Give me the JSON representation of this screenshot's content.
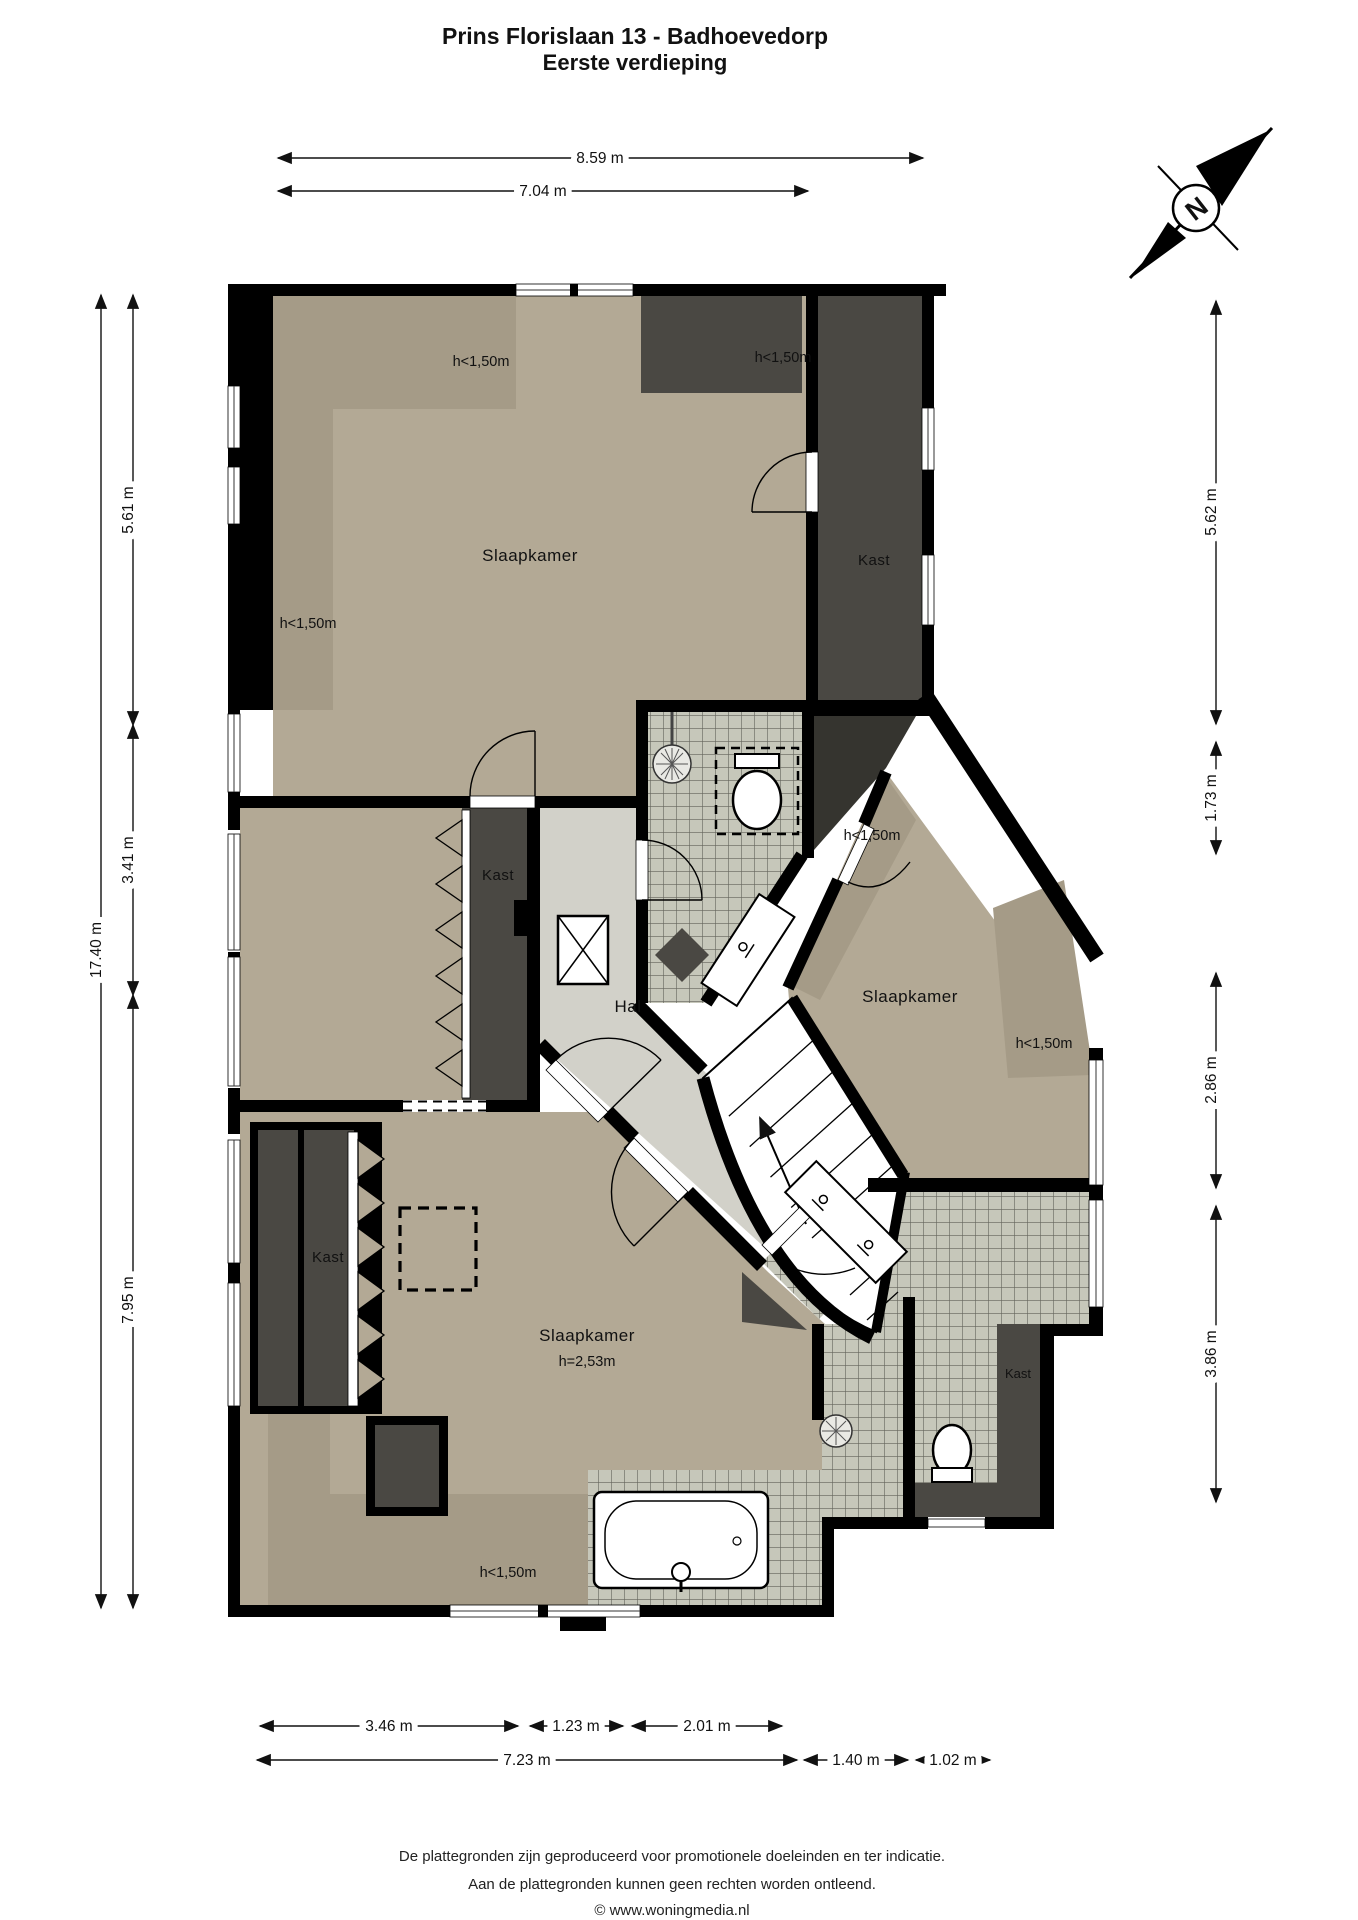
{
  "title": {
    "line1": "Prins Florislaan 13 - Badhoevedorp",
    "line2": "Eerste verdieping"
  },
  "compass": {
    "north_letter": "N"
  },
  "rooms": {
    "bedroom_top_left": "Slaapkamer",
    "closet_top_right": "Kast",
    "closet_middle_left": "Kast",
    "hall": "Hal",
    "bedroom_right": "Slaapkamer",
    "bedroom_bottom": "Slaapkamer",
    "bedroom_bottom_height": "h=2,53m",
    "closet_bottom_left": "Kast",
    "closet_bathroom": "Kast",
    "height_restriction": "h<1,50m"
  },
  "dimensions": {
    "top": [
      {
        "label": "8.59 m"
      },
      {
        "label": "7.04 m"
      }
    ],
    "left": [
      {
        "label": "17.40 m"
      },
      {
        "label": "5.61 m"
      },
      {
        "label": "3.41 m"
      },
      {
        "label": "7.95 m"
      }
    ],
    "right": [
      {
        "label": "5.62 m"
      },
      {
        "label": "1.73 m"
      },
      {
        "label": "2.86 m"
      },
      {
        "label": "3.86 m"
      }
    ],
    "bottom": [
      {
        "label": "3.46 m"
      },
      {
        "label": "1.23 m"
      },
      {
        "label": "2.01 m"
      },
      {
        "label": "7.23 m"
      },
      {
        "label": "1.40 m"
      },
      {
        "label": "1.02 m"
      }
    ]
  },
  "footer": {
    "line1": "De plattegronden zijn geproduceerd voor promotionele doeleinden en ter indicatie.",
    "line2": "Aan de plattegronden kunnen geen rechten worden ontleend.",
    "line3": "© www.woningmedia.nl"
  },
  "colors": {
    "wall": "#000000",
    "floor": "#b3a995",
    "floor_low": "#a59b87",
    "hall_floor": "#d2d1c9",
    "closet": "#4a4843",
    "tile": "#c6c7ba",
    "tile_line": "#63635b"
  }
}
